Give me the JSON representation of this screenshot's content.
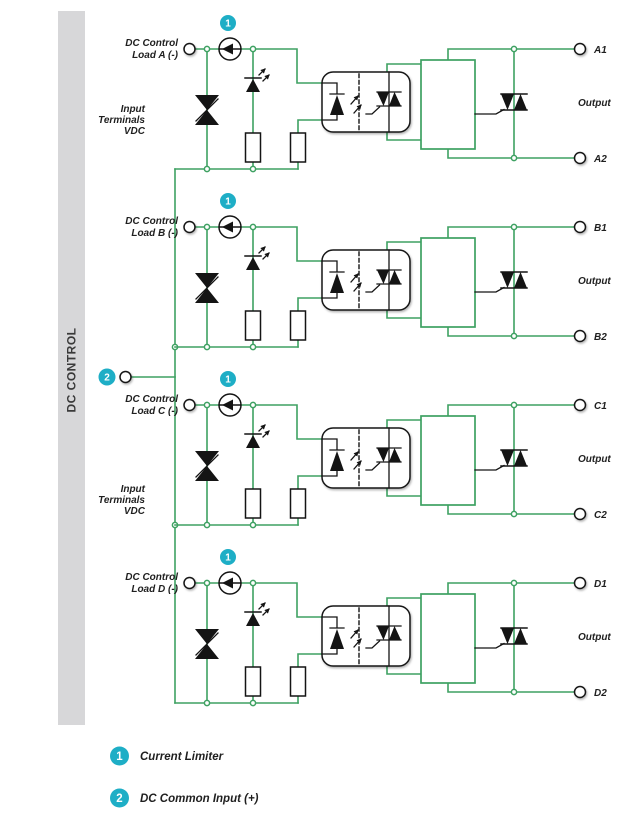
{
  "colors": {
    "wire_green": "#3EA162",
    "badge_cyan": "#1EAEC6",
    "sidebar_gray": "#D7D7D9",
    "ink_black": "#141414",
    "label_text": "#1F1F1F"
  },
  "sidebar": {
    "label": "DC CONTROL"
  },
  "badges": {
    "current_limiter": "1",
    "dc_common": "2"
  },
  "channels": [
    {
      "id": "A",
      "label_line1": "DC Control",
      "label_line2": "Load A (-)",
      "input_terminals_line1": "Input",
      "input_terminals_line2": "Terminals",
      "input_terminals_line3": "VDC",
      "output_label": "Output",
      "terminal1": "A1",
      "terminal2": "A2"
    },
    {
      "id": "B",
      "label_line1": "DC Control",
      "label_line2": "Load B (-)",
      "output_label": "Output",
      "terminal1": "B1",
      "terminal2": "B2"
    },
    {
      "id": "C",
      "label_line1": "DC Control",
      "label_line2": "Load C (-)",
      "input_terminals_line1": "Input",
      "input_terminals_line2": "Terminals",
      "input_terminals_line3": "VDC",
      "output_label": "Output",
      "terminal1": "C1",
      "terminal2": "C2"
    },
    {
      "id": "D",
      "label_line1": "DC Control",
      "label_line2": "Load D (-)",
      "output_label": "Output",
      "terminal1": "D1",
      "terminal2": "D2"
    }
  ],
  "legend": [
    {
      "num": "1",
      "label": "Current Limiter"
    },
    {
      "num": "2",
      "label": "DC Common Input (+)"
    }
  ]
}
